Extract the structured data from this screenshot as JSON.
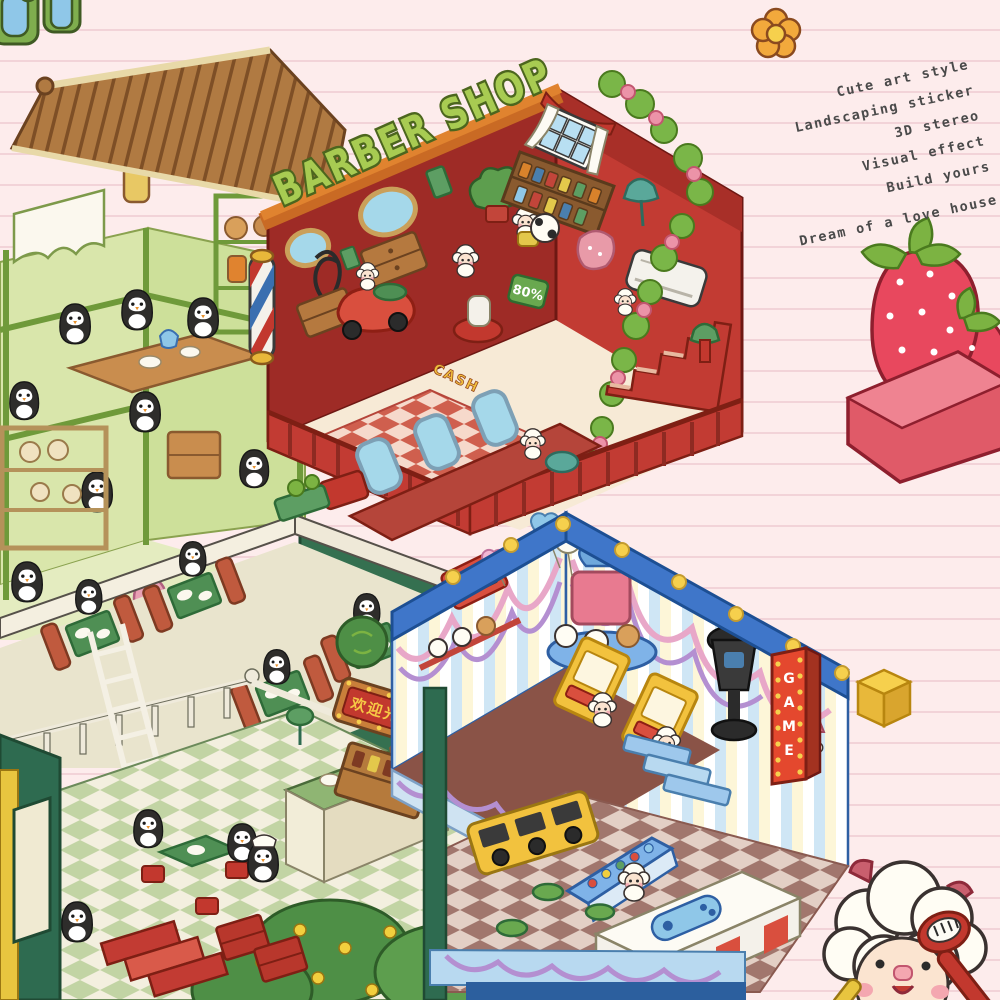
{
  "title": "BARBER SHOP",
  "tagline": {
    "lines": [
      "Cute art style",
      "Landscaping sticker",
      "3D stereo",
      "Visual effect",
      "Build yours",
      "Dream of a love house"
    ]
  },
  "signs": {
    "welcome": "欢迎光临",
    "game_letters": [
      "G",
      "A",
      "M",
      "E"
    ],
    "discount": "80%",
    "cash": "CASH"
  },
  "palette": {
    "background": "#fdecec",
    "paper_line": "#f2d3d8",
    "barber_red": "#c23b33",
    "barber_dark_red": "#9e2b26",
    "beam_orange": "#e0832f",
    "title_green": "#a8cb52",
    "title_outline": "#4c661e",
    "tea_roof_brown": "#a97743",
    "tea_wall_green": "#d9e6ab",
    "restaurant_green": "#2e6b50",
    "booth_red": "#c05a3e",
    "arcade_blue": "#3f76c9",
    "stripe_cream": "#fdf6d8",
    "stripe_blue": "#cfe6f5",
    "garland_pink": "#e8a7c8",
    "garland_purple": "#b48fd1",
    "bulb_yellow": "#f6d04d",
    "game_sign_red": "#e4482e",
    "welcome_text_yellow": "#f6c945",
    "sofa_pink": "#e05a68",
    "strawberry_red": "#e8485e",
    "leaf_green": "#7cb342",
    "sheep_cream": "#fffdf4",
    "penguin_black": "#2e2d2b",
    "tagline_text": "#4a4a4a"
  },
  "decorations": [
    "flower-icon",
    "strawberry-sofa",
    "sheep-mascot",
    "barber-pole",
    "canisters"
  ]
}
